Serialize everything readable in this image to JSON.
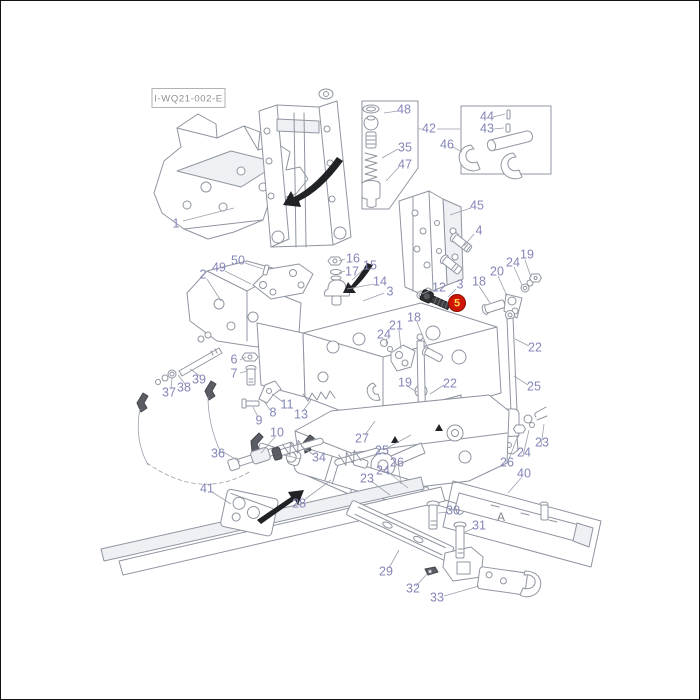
{
  "diagram": {
    "code_label": "I-WQ21-002-E",
    "highlight": {
      "id": "5",
      "x": 456,
      "y": 302
    },
    "reference_letters": [
      {
        "label": "A",
        "x": 500,
        "y": 517
      }
    ],
    "callouts": [
      {
        "id": "1",
        "x": 175,
        "y": 223
      },
      {
        "id": "2",
        "x": 202,
        "y": 274
      },
      {
        "id": "49",
        "x": 218,
        "y": 267
      },
      {
        "id": "50",
        "x": 237,
        "y": 260
      },
      {
        "id": "16",
        "x": 352,
        "y": 258
      },
      {
        "id": "17",
        "x": 351,
        "y": 271
      },
      {
        "id": "15",
        "x": 369,
        "y": 265
      },
      {
        "id": "14",
        "x": 379,
        "y": 281
      },
      {
        "id": "3",
        "x": 389,
        "y": 291
      },
      {
        "id": "12",
        "x": 438,
        "y": 287
      },
      {
        "id": "3",
        "x": 459,
        "y": 284
      },
      {
        "id": "18",
        "x": 478,
        "y": 281
      },
      {
        "id": "20",
        "x": 496,
        "y": 271
      },
      {
        "id": "24",
        "x": 512,
        "y": 262
      },
      {
        "id": "19",
        "x": 526,
        "y": 254
      },
      {
        "id": "45",
        "x": 476,
        "y": 205
      },
      {
        "id": "4",
        "x": 478,
        "y": 230
      },
      {
        "id": "48",
        "x": 403,
        "y": 109
      },
      {
        "id": "35",
        "x": 404,
        "y": 147
      },
      {
        "id": "47",
        "x": 404,
        "y": 164
      },
      {
        "id": "42",
        "x": 428,
        "y": 128
      },
      {
        "id": "46",
        "x": 446,
        "y": 144
      },
      {
        "id": "44",
        "x": 486,
        "y": 116
      },
      {
        "id": "43",
        "x": 486,
        "y": 128
      },
      {
        "id": "22",
        "x": 534,
        "y": 347
      },
      {
        "id": "18",
        "x": 413,
        "y": 317
      },
      {
        "id": "21",
        "x": 395,
        "y": 325
      },
      {
        "id": "24",
        "x": 383,
        "y": 334
      },
      {
        "id": "6",
        "x": 233,
        "y": 359
      },
      {
        "id": "7",
        "x": 233,
        "y": 373
      },
      {
        "id": "37",
        "x": 168,
        "y": 392
      },
      {
        "id": "38",
        "x": 183,
        "y": 387
      },
      {
        "id": "39",
        "x": 198,
        "y": 379
      },
      {
        "id": "9",
        "x": 258,
        "y": 420
      },
      {
        "id": "8",
        "x": 272,
        "y": 412
      },
      {
        "id": "11",
        "x": 286,
        "y": 404
      },
      {
        "id": "13",
        "x": 300,
        "y": 414
      },
      {
        "id": "10",
        "x": 276,
        "y": 432
      },
      {
        "id": "36",
        "x": 217,
        "y": 453
      },
      {
        "id": "41",
        "x": 206,
        "y": 488
      },
      {
        "id": "34",
        "x": 318,
        "y": 457
      },
      {
        "id": "28",
        "x": 298,
        "y": 503
      },
      {
        "id": "27",
        "x": 361,
        "y": 438
      },
      {
        "id": "25",
        "x": 381,
        "y": 450
      },
      {
        "id": "26",
        "x": 396,
        "y": 462
      },
      {
        "id": "24",
        "x": 382,
        "y": 470
      },
      {
        "id": "23",
        "x": 366,
        "y": 478
      },
      {
        "id": "19",
        "x": 404,
        "y": 382
      },
      {
        "id": "22",
        "x": 449,
        "y": 383
      },
      {
        "id": "25",
        "x": 533,
        "y": 386
      },
      {
        "id": "23",
        "x": 541,
        "y": 442
      },
      {
        "id": "24",
        "x": 523,
        "y": 452
      },
      {
        "id": "26",
        "x": 506,
        "y": 462
      },
      {
        "id": "40",
        "x": 523,
        "y": 473
      },
      {
        "id": "30",
        "x": 452,
        "y": 510
      },
      {
        "id": "31",
        "x": 478,
        "y": 525
      },
      {
        "id": "29",
        "x": 385,
        "y": 571
      },
      {
        "id": "32",
        "x": 412,
        "y": 588
      },
      {
        "id": "33",
        "x": 436,
        "y": 597
      }
    ]
  },
  "colors": {
    "callout": "#8486b8",
    "highlight_bg": "#cf1505",
    "highlight_ring": "#8a0e00",
    "highlight_text": "#ffd34d",
    "line_art": "#8f95a0",
    "background": "#ffffff"
  }
}
